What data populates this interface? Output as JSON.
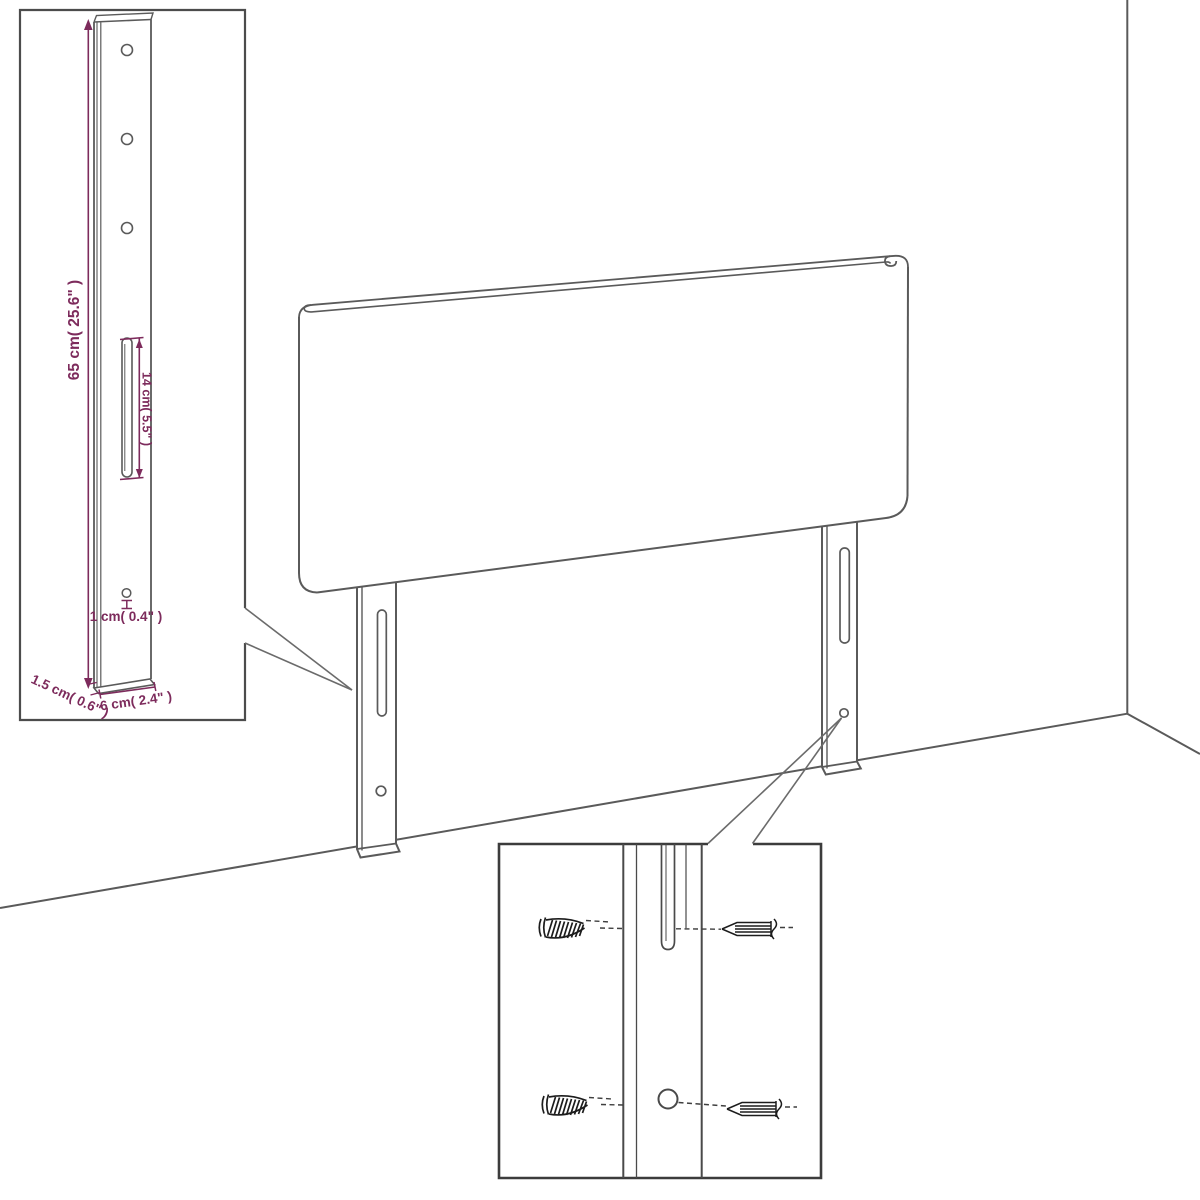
{
  "diagram": {
    "title": "headboard-assembly-diagram",
    "subject": "upholstered headboard with two mounting legs in room corner",
    "colors": {
      "background": "#ffffff",
      "line_gray": "#5a5a5a",
      "inset_border": "#454545",
      "screw_black": "#1c1c1c",
      "dimension_purple": "#7d2b5c"
    },
    "inset_top_left": {
      "description": "leg-dimension-detail",
      "labels": {
        "height": "65 cm( 25.6\" )",
        "slot_length": "14 cm( 5.5\" )",
        "hole": "1 cm( 0.4\" )",
        "thickness": "1.5 cm( 0.6\" )",
        "width": "6 cm( 2.4\" )"
      },
      "features": {
        "screw_holes": 3,
        "slot": 1,
        "small_hole": 1
      }
    },
    "inset_bottom": {
      "description": "mounting-screw-detail",
      "features": {
        "threaded_screws": 2,
        "pointed_screws": 2,
        "slot": 1,
        "hole": 1
      }
    },
    "main_view": {
      "legs": 2,
      "slots_per_leg": 1,
      "holes_per_leg": 1
    }
  }
}
